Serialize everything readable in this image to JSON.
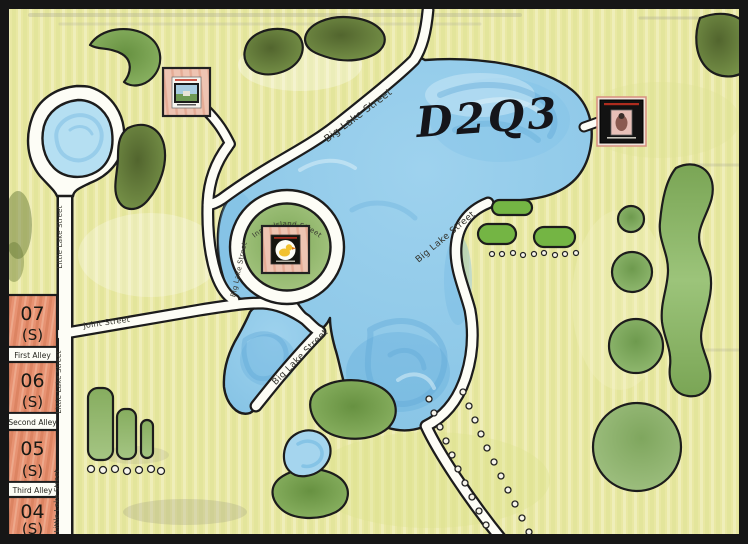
{
  "map": {
    "code_label": "D2Q3",
    "type": "hand-drawn neighborhood lake map"
  },
  "streets": {
    "little_lake": "Little Lake Street",
    "big_lake": "Big Lake Street",
    "joint": "Joint Street",
    "inner_island": "Inner Island Street"
  },
  "houses": [
    {
      "number": "07",
      "suffix": "(S)"
    },
    {
      "number": "06",
      "suffix": "(S)"
    },
    {
      "number": "05",
      "suffix": "(S)"
    },
    {
      "number": "04",
      "suffix": "(S)"
    }
  ],
  "alleys": [
    {
      "label": "First Alley"
    },
    {
      "label": "Second Alley"
    },
    {
      "label": "Third Alley"
    }
  ],
  "markers": [
    {
      "name": "framed-photo-marker",
      "location": "top-left park"
    },
    {
      "name": "duck-medallion-marker",
      "location": "island center"
    },
    {
      "name": "stamp-marker",
      "location": "east shore"
    }
  ],
  "colors": {
    "land": "#e9e8a3",
    "water": "#8cc8e8",
    "road": "#fdfdf6",
    "outline": "#1c1c1c",
    "house_tile": "#e79272",
    "marker_frame_pink": "#eec4b2",
    "bush_green": "#679141",
    "dark_bush_green": "#52652e"
  }
}
